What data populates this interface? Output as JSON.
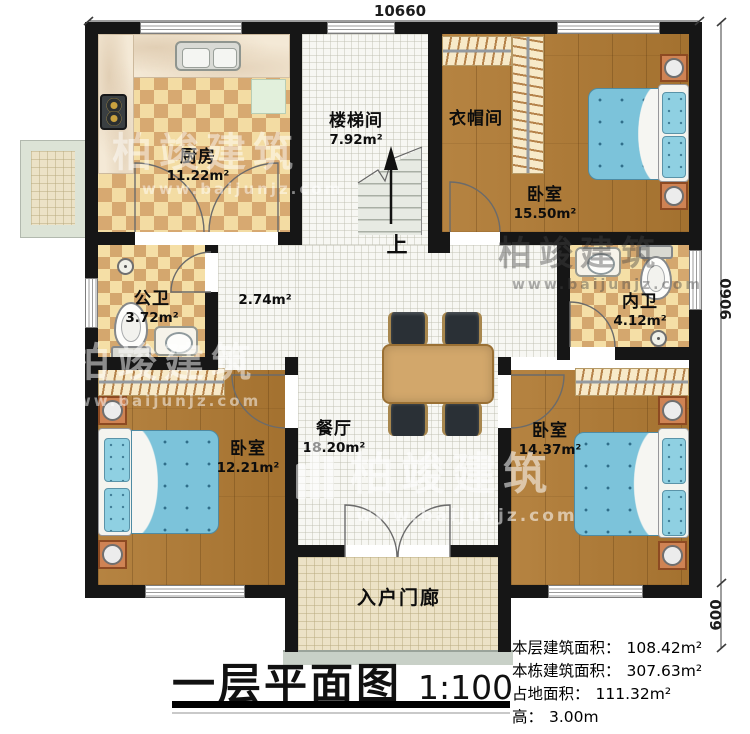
{
  "title": {
    "text": "一层平面图",
    "scale": "1:100"
  },
  "dimensions": {
    "width_total": "10660",
    "height_main": "9060",
    "porch_depth": "600"
  },
  "rooms": {
    "kitchen": {
      "name": "厨房",
      "area": "11.22m²"
    },
    "stairwell": {
      "name": "楼梯间",
      "area": "7.92m²",
      "up": "上"
    },
    "cloakroom": {
      "name": "衣帽间"
    },
    "bedroom_ne": {
      "name": "卧室",
      "area": "15.50m²"
    },
    "public_bath": {
      "name": "公卫",
      "area": "3.72m²"
    },
    "hallway": {
      "area": "2.74m²"
    },
    "ensuite_bath": {
      "name": "内卫",
      "area": "4.12m²"
    },
    "bedroom_sw": {
      "name": "卧室",
      "area": "12.21m²"
    },
    "dining": {
      "name": "餐厅",
      "area": "18.20m²"
    },
    "bedroom_se": {
      "name": "卧室",
      "area": "14.37m²"
    },
    "porch": {
      "name": "入户门廊"
    }
  },
  "info": [
    {
      "label": "本层建筑面积：",
      "value": "108.42m²"
    },
    {
      "label": "本栋建筑面积：",
      "value": "307.63m²"
    },
    {
      "label": "占地面积：",
      "value": "111.32m²"
    },
    {
      "label": "高：",
      "value": "3.00m"
    }
  ],
  "watermark": {
    "brand": "柏竣建筑",
    "url": "www.baijunjz.com"
  },
  "colors": {
    "wall": "#161616",
    "tile_light": "#f3dca3",
    "tile_dark": "#d7a971",
    "wood": "#b07a33",
    "bed_blue": "#7cc3da",
    "nightstand": "#cf8354",
    "table": "#d2a76b"
  }
}
